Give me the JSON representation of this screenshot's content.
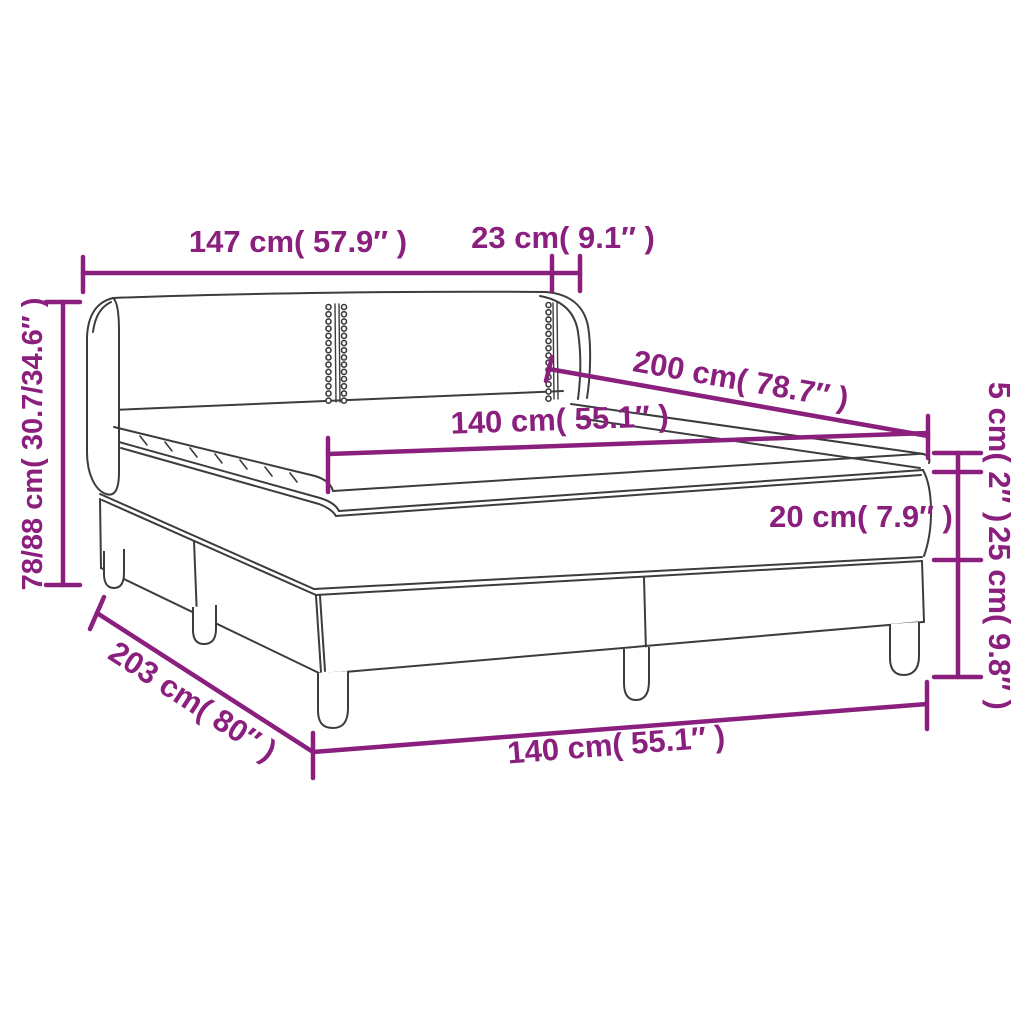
{
  "diagram": {
    "subject": "box spring bed with headboard, mattress and topper",
    "view": "isometric line drawing with dimension callouts"
  },
  "colors": {
    "dimension_accent": "#8A1F7E",
    "drawing_outline": "#3C3C3C",
    "background": "#FFFFFF"
  },
  "labels": {
    "top_width": "147 cm( 57.9″ )",
    "top_side": "23 cm( 9.1″ )",
    "height_total": "78/88 cm( 30.7/34.6″ )",
    "length_top": "200 cm( 78.7″ )",
    "width_mattress": "140 cm( 55.1″ )",
    "topper_height": "5 cm( 2″ )",
    "mattress_height": "20 cm( 7.9″ )",
    "base_height": "25 cm( 9.8″ )",
    "length_base": "203 cm( 80″ )",
    "width_base": "140 cm( 55.1″ )"
  },
  "measurements": [
    {
      "part": "headboard width",
      "cm": "147",
      "inches": "57.9"
    },
    {
      "part": "headboard wing depth",
      "cm": "23",
      "inches": "9.1"
    },
    {
      "part": "total height",
      "cm": "78/88",
      "inches": "30.7/34.6"
    },
    {
      "part": "bed length",
      "cm": "200",
      "inches": "78.7"
    },
    {
      "part": "mattress width",
      "cm": "140",
      "inches": "55.1"
    },
    {
      "part": "topper thickness",
      "cm": "5",
      "inches": "2"
    },
    {
      "part": "mattress thickness",
      "cm": "20",
      "inches": "7.9"
    },
    {
      "part": "base height incl. legs",
      "cm": "25",
      "inches": "9.8"
    },
    {
      "part": "base length",
      "cm": "203",
      "inches": "80"
    },
    {
      "part": "base width",
      "cm": "140",
      "inches": "55.1"
    }
  ]
}
